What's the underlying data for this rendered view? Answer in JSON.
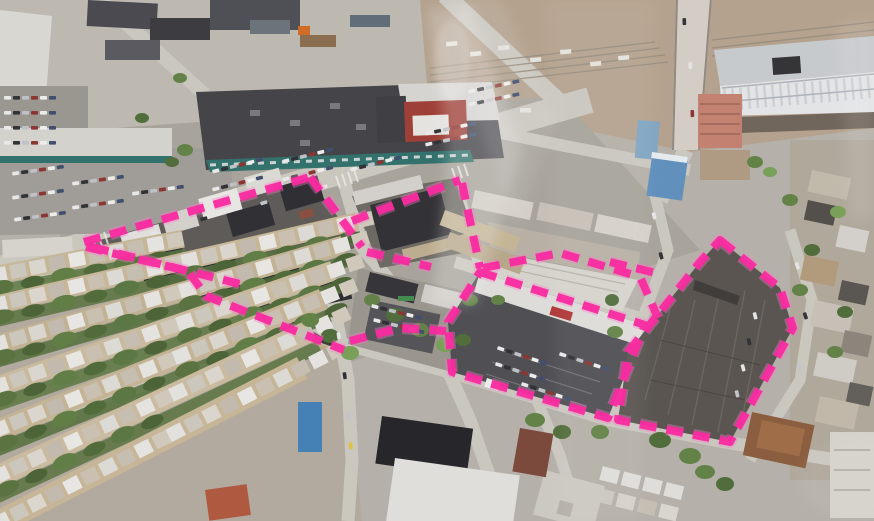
{
  "photo": {
    "kind": "oblique-aerial-photograph",
    "scene": "city-blocks-with-development-site-outlined",
    "width_px": 874,
    "height_px": 521
  },
  "annotation": {
    "color": "#ff24a0",
    "glow_color": "#ff7ec9",
    "stroke_width": 8,
    "dash": "17 10",
    "outlines": [
      {
        "name": "parcel-outline-north-block-top-edge",
        "path": "M84,242 L310,177"
      },
      {
        "name": "parcel-outline-north-block-east-edge",
        "path": "M310,177 L362,247"
      },
      {
        "name": "parcel-outline-inner-divider",
        "path": "M92,247 L240,284"
      },
      {
        "name": "parcel-outline-south-boundary",
        "path": "M86,247 L188,271 L206,296 L344,350"
      },
      {
        "name": "parcel-outline-mid-block-top-edge",
        "path": "M352,221 L460,180"
      },
      {
        "name": "parcel-outline-mid-block-east-edge",
        "path": "M462,183 L480,268"
      },
      {
        "name": "parcel-outline-mid-block-south-edge",
        "path": "M367,252 L431,267"
      },
      {
        "name": "parcel-outline-mid-connector",
        "path": "M350,341 L400,328 L446,331"
      },
      {
        "name": "parcel-outline-warehouse-block-top",
        "path": "M483,268 L560,253 L640,277"
      },
      {
        "name": "parcel-outline-warehouse-block-east",
        "path": "M641,279 L658,318"
      },
      {
        "name": "parcel-outline-street-segment",
        "path": "M610,262 L656,273"
      },
      {
        "name": "parcel-outline-retail-parking-block",
        "path": "M480,272 L645,325 L608,418 L452,372 L448,322 Z"
      },
      {
        "name": "parcel-outline-paved-lot-block",
        "path": "M720,240 L780,288 L793,328 L730,442 L618,420 L628,352 L700,262 Z"
      }
    ]
  },
  "palette": {
    "ground": "#b6b1a8",
    "street": "#cdc9c0",
    "dark_roof": "#2c2b2f",
    "light_roof": "#e6e4df",
    "vegetation": "#5c7d3c",
    "rail_yard": "#b5a28c",
    "paved_lot": "#55504a",
    "teal_storefront": "#2c6f68",
    "red_store": "#9e3a30",
    "glare": "#ffffff"
  }
}
